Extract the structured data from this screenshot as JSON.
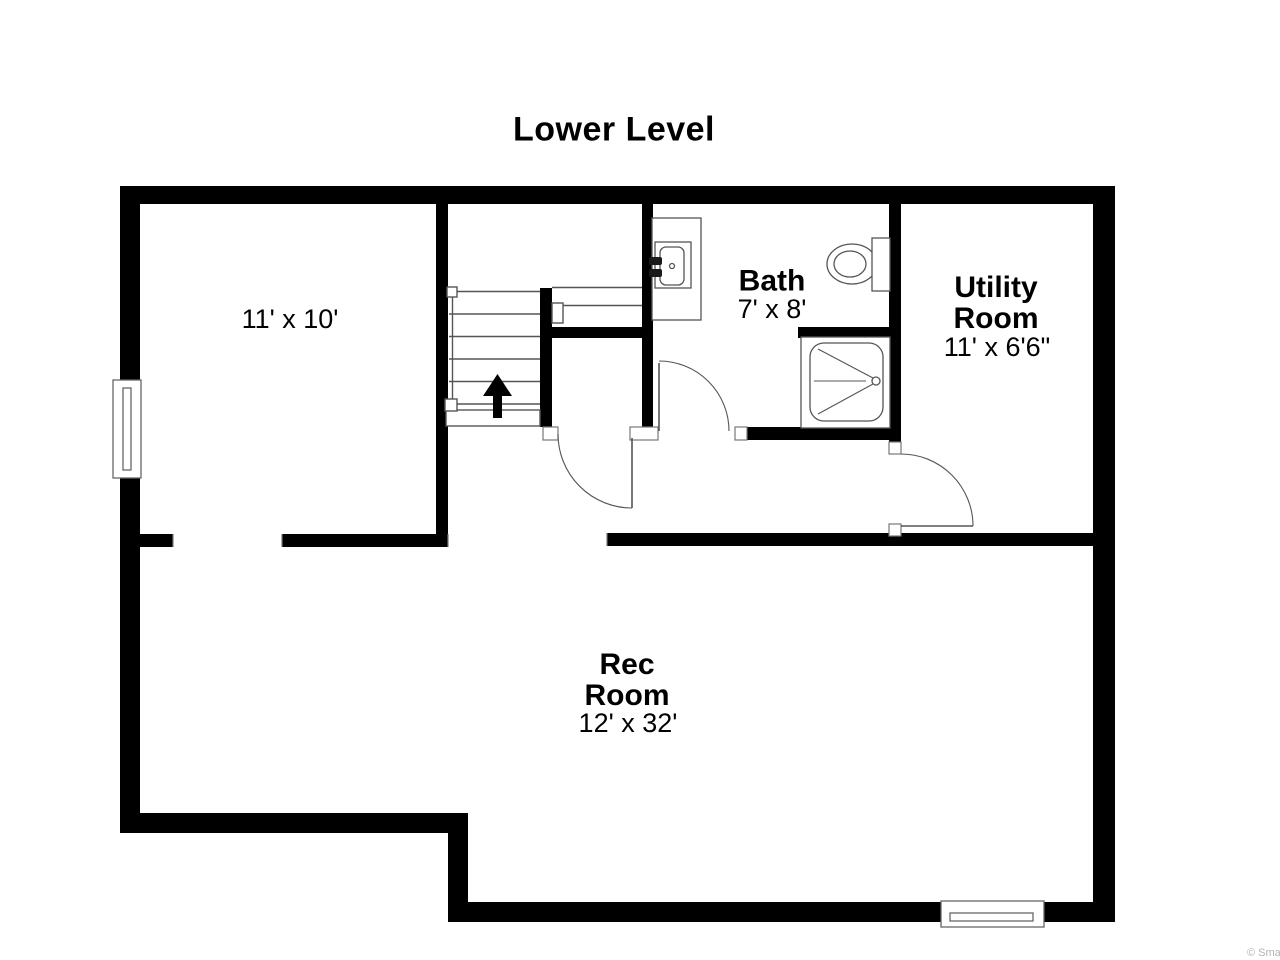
{
  "title": "Lower Level",
  "rooms": [
    {
      "name": "",
      "dims": "11' x 10'"
    },
    {
      "name": "Bath",
      "dims": "7' x 8'"
    },
    {
      "name": "Utility\nRoom",
      "dims": "11' x 6'6\""
    },
    {
      "name": "Rec\nRoom",
      "dims": "12' x 32'"
    }
  ],
  "fixtures": [
    "staircase-up-arrow",
    "vanity-sink",
    "toilet",
    "shower",
    "window-left",
    "window-bottom",
    "door-bath",
    "door-hall",
    "door-utility"
  ],
  "watermark": "© Smar",
  "colors": {
    "wall": "#000000",
    "thin_line": "#555555",
    "background": "#ffffff",
    "text": "#000000",
    "watermark": "#b4b4b4"
  }
}
